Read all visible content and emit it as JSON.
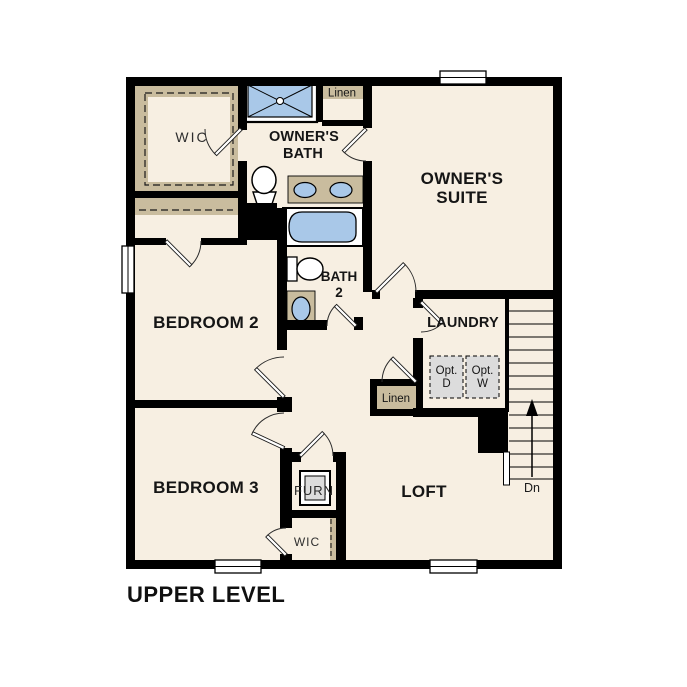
{
  "title": "UPPER LEVEL",
  "colors": {
    "floor": "#f7efe2",
    "tan": "#c9bc9e",
    "fixture_blue": "#a9c8e8",
    "appliance_gray": "#dcdcdc",
    "wall": "#000000"
  },
  "rooms": {
    "wic_top": "WIC",
    "owners_bath": [
      "OWNER'S",
      "BATH"
    ],
    "linen_top": "Linen",
    "owners_suite": [
      "OWNER'S",
      "SUITE"
    ],
    "bedroom2": "BEDROOM 2",
    "bath2": [
      "BATH",
      "2"
    ],
    "laundry": "LAUNDRY",
    "opt_dryer": [
      "Opt.",
      "D"
    ],
    "opt_washer": [
      "Opt.",
      "W"
    ],
    "linen_hall": "Linen",
    "bedroom3": "BEDROOM 3",
    "furnace": "FURN",
    "loft": "LOFT",
    "wic_bottom": "WIC",
    "stairs_down": "Dn"
  }
}
